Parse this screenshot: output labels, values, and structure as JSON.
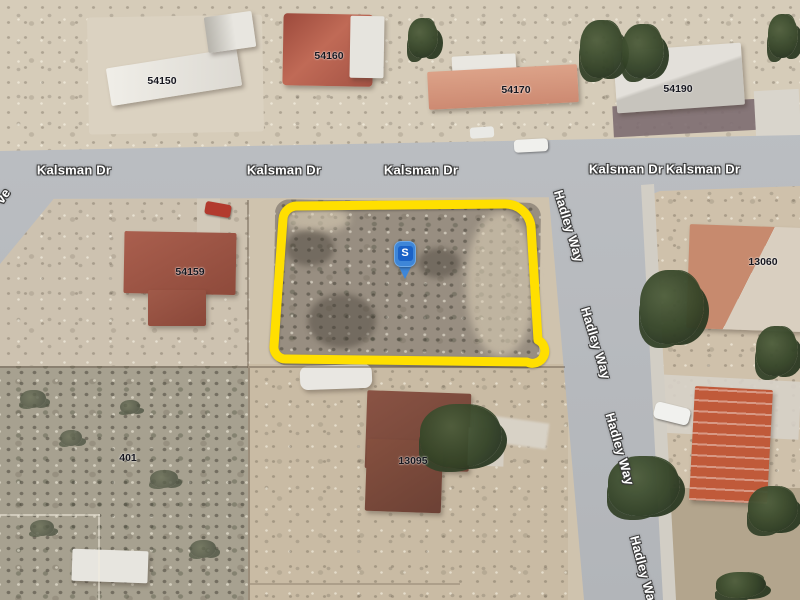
{
  "map": {
    "view_type": "satellite-aerial",
    "street_labels": [
      {
        "text": "Kalsman Dr"
      },
      {
        "text": "Kalsman Dr"
      },
      {
        "text": "Kalsman Dr"
      },
      {
        "text": "Kalsman Dr"
      },
      {
        "text": "Kalsman Dr"
      },
      {
        "text": "Hadley Way"
      },
      {
        "text": "Hadley Way"
      },
      {
        "text": "Hadley Way"
      },
      {
        "text": "Hadley Way"
      },
      {
        "text": "ve"
      }
    ],
    "parcel_numbers": [
      {
        "text": "54150"
      },
      {
        "text": "54160"
      },
      {
        "text": "54170"
      },
      {
        "text": "54190"
      },
      {
        "text": "54159"
      },
      {
        "text": "13060"
      },
      {
        "text": "13095"
      },
      {
        "text": "401"
      }
    ],
    "highlight": {
      "color": "#FFDF00"
    },
    "marker": {
      "letter": "S",
      "outer": "#3E86D8",
      "inner": "#1A61C6",
      "rim": "#6FA9E6"
    }
  }
}
